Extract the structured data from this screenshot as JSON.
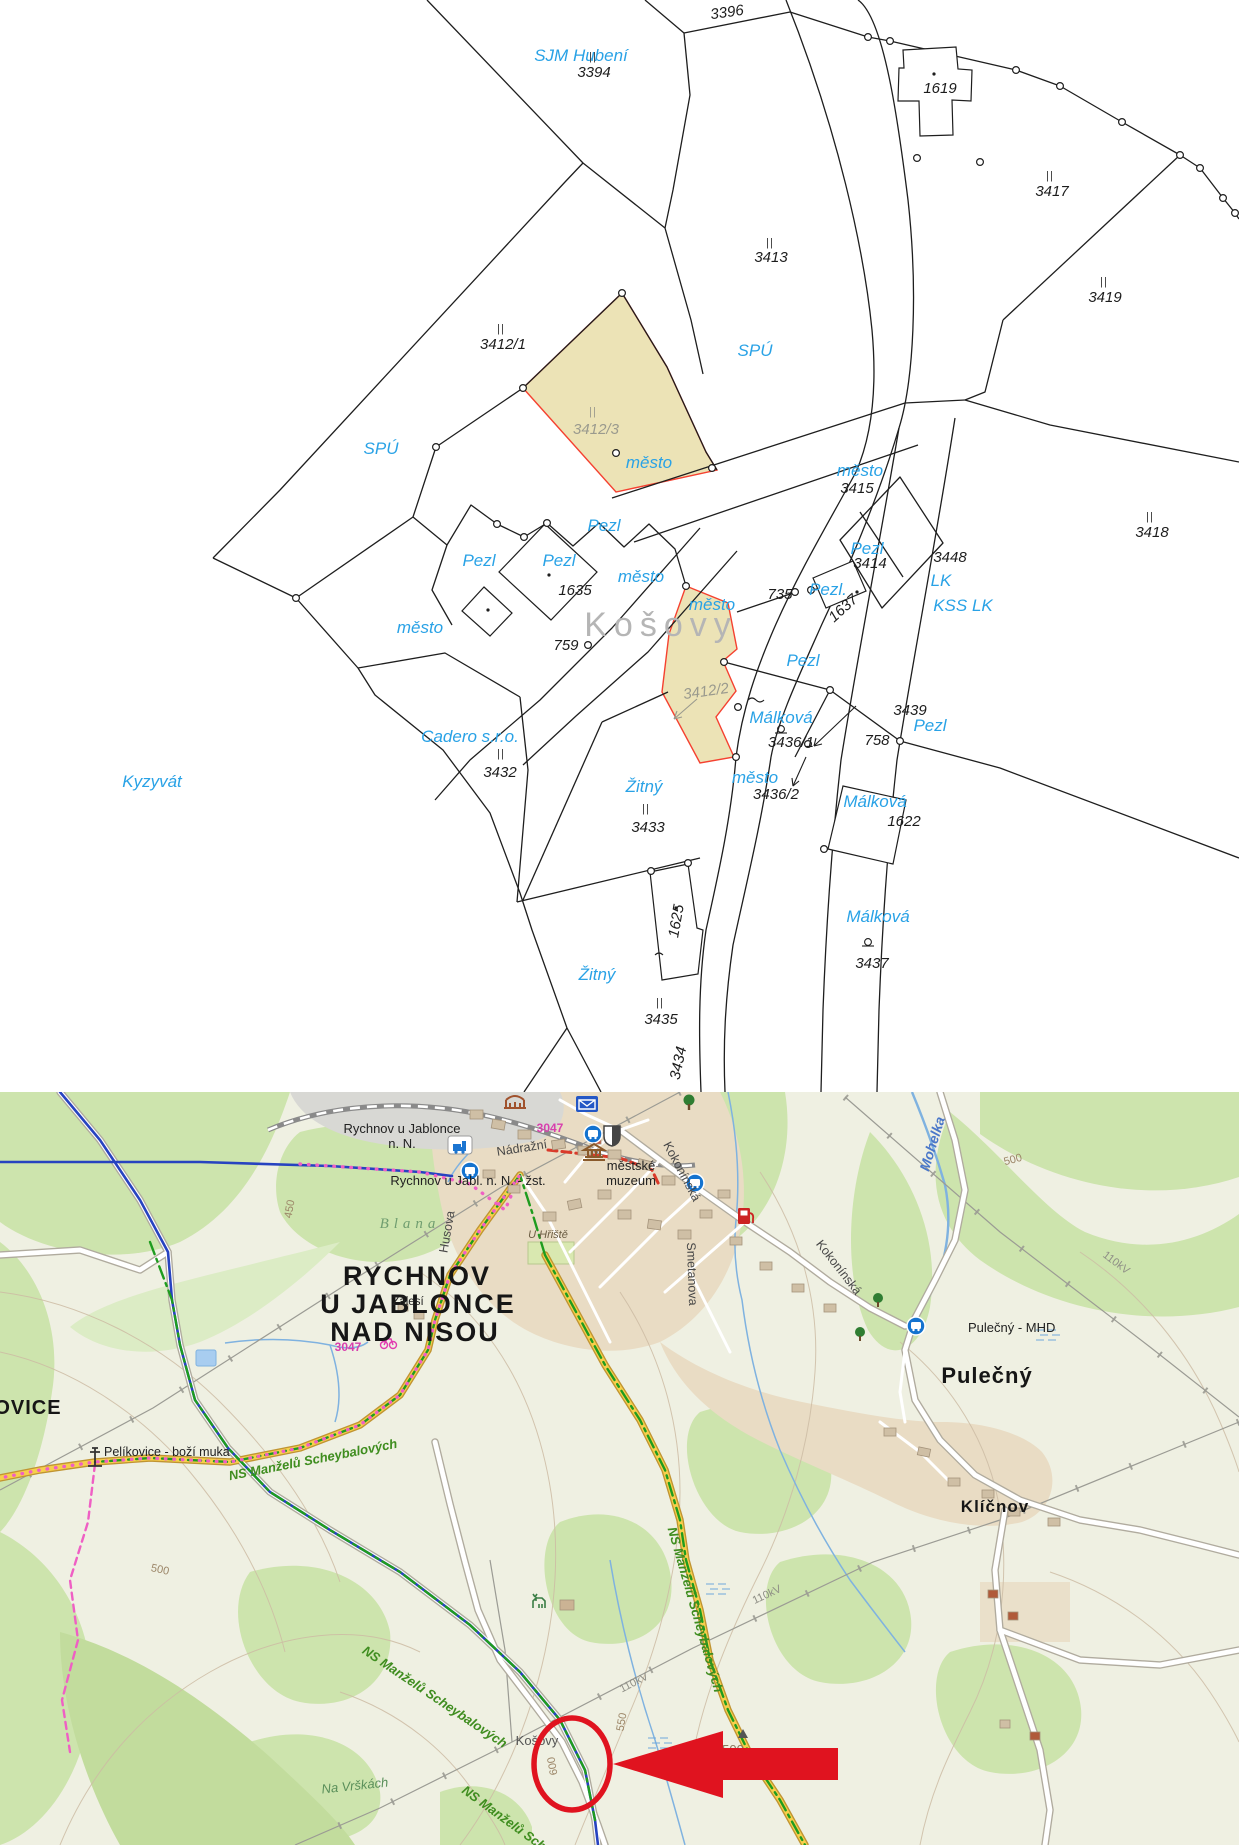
{
  "colors": {
    "owner_blue": "#29a2e6",
    "highlight_fill": "#ece3b6",
    "highlight_outline": "#f54130",
    "annotation_red": "#e0131f",
    "forest_green": "#cde4ad",
    "town_beige": "#e9dcc4",
    "road_yellow": "#f7cf4b"
  },
  "c": {
    "watermark": "Košovy",
    "tick": "||",
    "owners": [
      "SJM Hubení",
      "SPÚ",
      "SPÚ",
      "město",
      "Pezl",
      "Pezl",
      "Pezl",
      "město",
      "město",
      "město",
      "Pezl",
      "Pezl.",
      "Pezl",
      "LK",
      "KSS LK",
      "město",
      "Málková",
      "Pezl",
      "město",
      "Žitný",
      "Cadero s.r.o.",
      "Kyzyvát",
      "Málková",
      "Málková",
      "Žitný"
    ],
    "nums": [
      "3396",
      "3394",
      "1619",
      "3413",
      "3417",
      "3419",
      "3412/1",
      "3412/3",
      "3415",
      "3414",
      "3448",
      "1637",
      "3418",
      "1635",
      "759",
      "735",
      "3412/2",
      "3436/1",
      "3439",
      "758",
      "3436/2",
      "3433",
      "3432",
      "1622",
      "1625",
      "3437",
      "3435",
      "3434"
    ]
  },
  "t": {
    "town": [
      "RYCHNOV",
      "U JABLONCE",
      "NAD NISOU"
    ],
    "villages": [
      "PELÍKOVICE",
      "Pulečný",
      "Klíčnov"
    ],
    "places": [
      "Rychnov u Jablonce",
      "n. N.",
      "Rychnov u Jabl. n. N. - žst.",
      "městské",
      "muzeum",
      "Pulečný - MHD",
      "Pelíkovice - boží muka",
      "Zálesí",
      "U Hřiště",
      "Košovy"
    ],
    "streets": [
      "Nádražní",
      "Husova",
      "Kokonínská",
      "Smetanova"
    ],
    "green": [
      "Blana",
      "Na Vrškách"
    ],
    "ns": "NS Manželů Scheybalových",
    "water": [
      "Mohelka"
    ],
    "contours": [
      "450",
      "500",
      "550",
      "600"
    ],
    "kv": "110kV",
    "badge": "3047"
  }
}
